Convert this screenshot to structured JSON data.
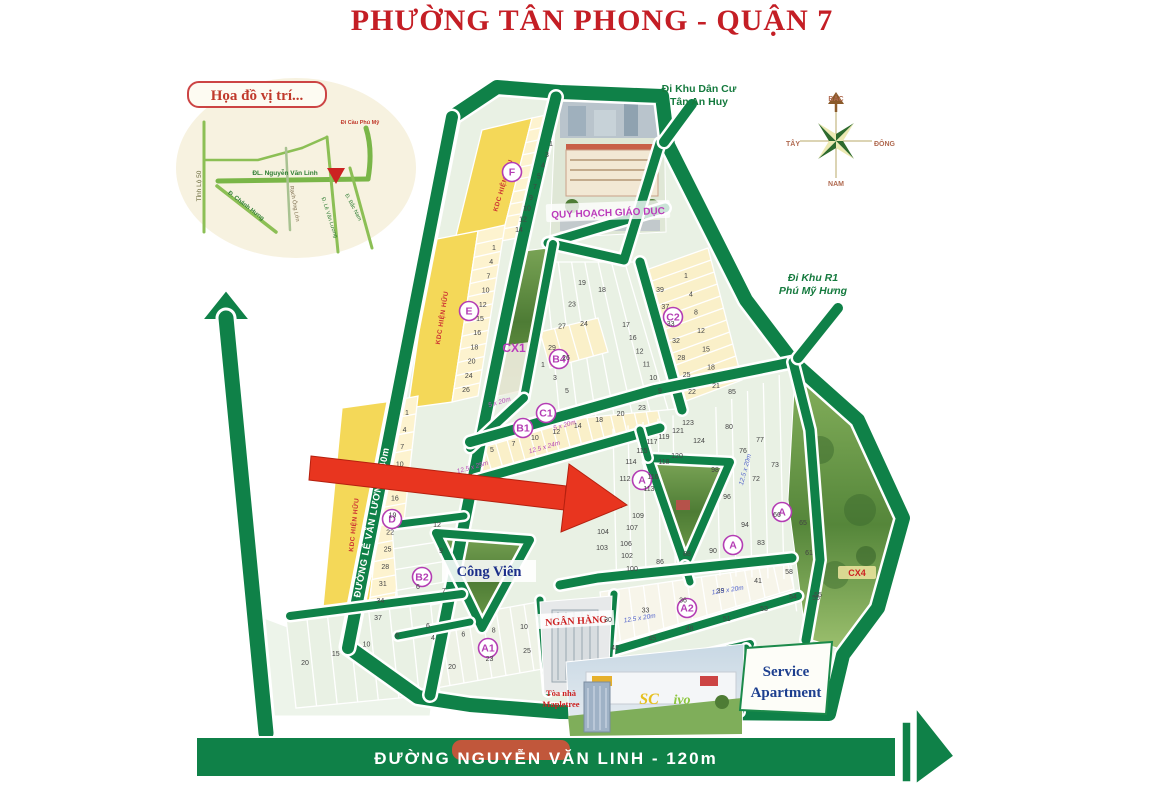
{
  "title": "PHƯỜNG TÂN PHONG - QUẬN 7",
  "inset": {
    "title": "Họa đồ vị trí...",
    "labels": [
      {
        "t": "Tỉnh Lộ 50",
        "x": 201,
        "y": 186,
        "r": -90,
        "s": 6.5,
        "c": "#6a6a3a",
        "w": "normal"
      },
      {
        "t": "ĐL. Nguyễn Văn Linh",
        "x": 285,
        "y": 175,
        "r": 0,
        "s": 6.5,
        "c": "#2e7d32",
        "w": "bold"
      },
      {
        "t": "Đ. Chánh Hưng",
        "x": 245,
        "y": 207,
        "r": 38,
        "s": 6,
        "c": "#2e7d32",
        "w": "bold"
      },
      {
        "t": "Rạch Ông Lớn",
        "x": 293,
        "y": 204,
        "r": 80,
        "s": 5.5,
        "c": "#7a6a4a",
        "w": "normal"
      },
      {
        "t": "Đ. Lê Văn Lương",
        "x": 328,
        "y": 218,
        "r": 72,
        "s": 5.5,
        "c": "#2e7d32",
        "w": "normal"
      },
      {
        "t": "Đ. Bắc Nam",
        "x": 352,
        "y": 208,
        "r": 62,
        "s": 5.5,
        "c": "#2e7d32",
        "w": "normal"
      },
      {
        "t": "Đi Cầu Phú Mỹ",
        "x": 360,
        "y": 124,
        "r": 0,
        "s": 5.5,
        "c": "#c0392b",
        "w": "bold"
      }
    ]
  },
  "compass": {
    "north": "BẮC",
    "south": "NAM",
    "west": "TÂY",
    "east": "ĐÔNG"
  },
  "roads": {
    "nht": "ĐƯỜNG NGUYỄN HỮU THỌ - 60m",
    "lvl": "ĐƯỜNG LÊ VĂN LƯƠNG - 40m",
    "nvl": "ĐƯỜNG NGUYỄN VĂN LINH  - 120m"
  },
  "directions": {
    "tan_an_huy": [
      "Đi Khu Dân Cư",
      "Tân An Huy"
    ],
    "phu_my_hung": [
      "Đi Khu R1",
      "Phú Mỹ Hưng"
    ]
  },
  "landmarks": {
    "education": "QUY HOẠCH GIÁO DỤC",
    "park": "Công Viên",
    "bank": "NGÂN HÀNG",
    "service": [
      "Service",
      "Apartment"
    ],
    "mapletree": [
      "Tòa nhà",
      "Mapletree"
    ],
    "cx1": "CX1",
    "cx4": "CX4",
    "sc": "SC",
    "ivo": "ivo",
    "kdc": "KDC HIỆN HỮU"
  },
  "map": {
    "block_circles": [
      {
        "t": "F",
        "x": 512,
        "y": 172
      },
      {
        "t": "E",
        "x": 469,
        "y": 311
      },
      {
        "t": "D",
        "x": 392,
        "y": 519
      },
      {
        "t": "C1",
        "x": 546,
        "y": 413
      },
      {
        "t": "B1",
        "x": 523,
        "y": 428
      },
      {
        "t": "B4",
        "x": 559,
        "y": 359
      },
      {
        "t": "C2",
        "x": 673,
        "y": 317
      },
      {
        "t": "B2",
        "x": 422,
        "y": 577
      },
      {
        "t": "A1",
        "x": 488,
        "y": 648
      },
      {
        "t": "A2",
        "x": 687,
        "y": 608
      },
      {
        "t": "A",
        "x": 642,
        "y": 480
      },
      {
        "t": "A",
        "x": 733,
        "y": 545
      },
      {
        "t": "A",
        "x": 782,
        "y": 512
      }
    ],
    "plot_runs": [
      {
        "n": [
          "1",
          "3",
          "4",
          "5",
          "7",
          "9",
          "10",
          "12",
          "14"
        ],
        "a": [
          551,
          146
        ],
        "b": [
          519,
          232
        ]
      },
      {
        "n": [
          "1",
          "4",
          "7",
          "10",
          "12",
          "15",
          "16",
          "18",
          "20",
          "24",
          "26"
        ],
        "a": [
          494,
          250
        ],
        "b": [
          466,
          392
        ]
      },
      {
        "n": [
          "1",
          "4",
          "7",
          "10",
          "13",
          "16",
          "19",
          "22",
          "25",
          "28",
          "31",
          "34",
          "37"
        ],
        "a": [
          407,
          415
        ],
        "b": [
          378,
          620
        ]
      },
      {
        "n": [
          "39",
          "37",
          "33",
          "32",
          "28",
          "25",
          "22"
        ],
        "a": [
          660,
          292
        ],
        "b": [
          692,
          394
        ]
      },
      {
        "n": [
          "1",
          "4",
          "8",
          "12",
          "15",
          "18",
          "21"
        ],
        "a": [
          686,
          278
        ],
        "b": [
          716,
          388
        ]
      },
      {
        "n": [
          "5",
          "7",
          "10",
          "12",
          "14",
          "18",
          "20",
          "23"
        ],
        "a": [
          492,
          452
        ],
        "b": [
          642,
          410
        ]
      },
      {
        "n": [
          "19",
          "23",
          "27",
          "29"
        ],
        "a": [
          582,
          285
        ],
        "b": [
          552,
          350
        ]
      },
      {
        "n": [
          "18",
          "24",
          "26"
        ],
        "a": [
          602,
          292
        ],
        "b": [
          566,
          360
        ]
      },
      {
        "n": [
          "17",
          "16",
          "12",
          "11",
          "10",
          "9"
        ],
        "a": [
          626,
          327
        ],
        "b": [
          660,
          393
        ]
      },
      {
        "n": [
          "1",
          "3",
          "5"
        ],
        "a": [
          543,
          367
        ],
        "b": [
          567,
          393
        ]
      },
      {
        "n": [
          "4",
          "6",
          "8",
          "10"
        ],
        "a": [
          433,
          640
        ],
        "b": [
          524,
          629
        ]
      },
      {
        "n": [
          "20",
          "23",
          "25"
        ],
        "a": [
          452,
          669
        ],
        "b": [
          527,
          653
        ]
      },
      {
        "n": [
          "30",
          "33",
          "36",
          "39",
          "41"
        ],
        "a": [
          608,
          622
        ],
        "b": [
          758,
          583
        ]
      },
      {
        "n": [
          "42",
          "45",
          "48",
          "51",
          "53"
        ],
        "a": [
          615,
          650
        ],
        "b": [
          764,
          611
        ]
      },
      {
        "n": [
          "20",
          "15",
          "10",
          "8",
          "6"
        ],
        "a": [
          305,
          665
        ],
        "b": [
          428,
          628
        ]
      },
      {
        "n": [
          "54",
          "55"
        ],
        "a": [
          793,
          599
        ],
        "b": [
          818,
          597
        ]
      },
      {
        "n": [
          "58"
        ],
        "a": [
          789,
          574
        ],
        "b": [
          789,
          574
        ]
      }
    ],
    "plot_labels": [
      {
        "t": "123",
        "x": 688,
        "y": 425
      },
      {
        "t": "121",
        "x": 678,
        "y": 433
      },
      {
        "t": "119",
        "x": 664,
        "y": 439
      },
      {
        "t": "124",
        "x": 699,
        "y": 443
      },
      {
        "t": "117",
        "x": 652,
        "y": 444
      },
      {
        "t": "120",
        "x": 677,
        "y": 458
      },
      {
        "t": "115",
        "x": 642,
        "y": 453
      },
      {
        "t": "118",
        "x": 664,
        "y": 464
      },
      {
        "t": "116",
        "x": 653,
        "y": 479
      },
      {
        "t": "114",
        "x": 631,
        "y": 464
      },
      {
        "t": "112",
        "x": 625,
        "y": 481
      },
      {
        "t": "113",
        "x": 649,
        "y": 491
      },
      {
        "t": "108",
        "x": 617,
        "y": 508
      },
      {
        "t": "109",
        "x": 638,
        "y": 518
      },
      {
        "t": "107",
        "x": 632,
        "y": 530
      },
      {
        "t": "104",
        "x": 603,
        "y": 534
      },
      {
        "t": "106",
        "x": 626,
        "y": 546
      },
      {
        "t": "103",
        "x": 602,
        "y": 550
      },
      {
        "t": "102",
        "x": 627,
        "y": 558
      },
      {
        "t": "100",
        "x": 632,
        "y": 571
      },
      {
        "t": "98",
        "x": 715,
        "y": 472
      },
      {
        "t": "96",
        "x": 727,
        "y": 499
      },
      {
        "t": "94",
        "x": 745,
        "y": 527
      },
      {
        "t": "90",
        "x": 713,
        "y": 553
      },
      {
        "t": "88",
        "x": 687,
        "y": 556
      },
      {
        "t": "86",
        "x": 660,
        "y": 564
      },
      {
        "t": "80",
        "x": 729,
        "y": 429
      },
      {
        "t": "77",
        "x": 760,
        "y": 442
      },
      {
        "t": "76",
        "x": 743,
        "y": 453
      },
      {
        "t": "73",
        "x": 775,
        "y": 467
      },
      {
        "t": "72",
        "x": 756,
        "y": 481
      },
      {
        "t": "83",
        "x": 761,
        "y": 545
      },
      {
        "t": "66",
        "x": 777,
        "y": 517
      },
      {
        "t": "65",
        "x": 803,
        "y": 525
      },
      {
        "t": "61",
        "x": 809,
        "y": 555
      },
      {
        "t": "55",
        "x": 816,
        "y": 600
      },
      {
        "t": "85",
        "x": 732,
        "y": 394
      },
      {
        "t": "12",
        "x": 437,
        "y": 527
      },
      {
        "t": "9",
        "x": 441,
        "y": 553
      },
      {
        "t": "6",
        "x": 418,
        "y": 589
      },
      {
        "t": "7",
        "x": 444,
        "y": 593
      }
    ],
    "dim_labels": [
      {
        "t": "5 x 20m",
        "x": 500,
        "y": 404,
        "r": -16,
        "c": "#b84ab8"
      },
      {
        "t": "5 x 20m",
        "x": 565,
        "y": 427,
        "r": -16,
        "c": "#b84ab8"
      },
      {
        "t": "12.5 x 24m",
        "x": 545,
        "y": 449,
        "r": -16,
        "c": "#b84ab8"
      },
      {
        "t": "12.5 x 25m",
        "x": 473,
        "y": 469,
        "r": -16,
        "c": "#b84ab8"
      },
      {
        "t": "12.5 x 20m",
        "x": 640,
        "y": 620,
        "r": -9,
        "c": "#5566cc"
      },
      {
        "t": "12.5 x 20m",
        "x": 728,
        "y": 592,
        "r": -9,
        "c": "#5566cc"
      },
      {
        "t": "12.5 x 20m",
        "x": 747,
        "y": 470,
        "r": -75,
        "c": "#5566cc"
      }
    ]
  }
}
